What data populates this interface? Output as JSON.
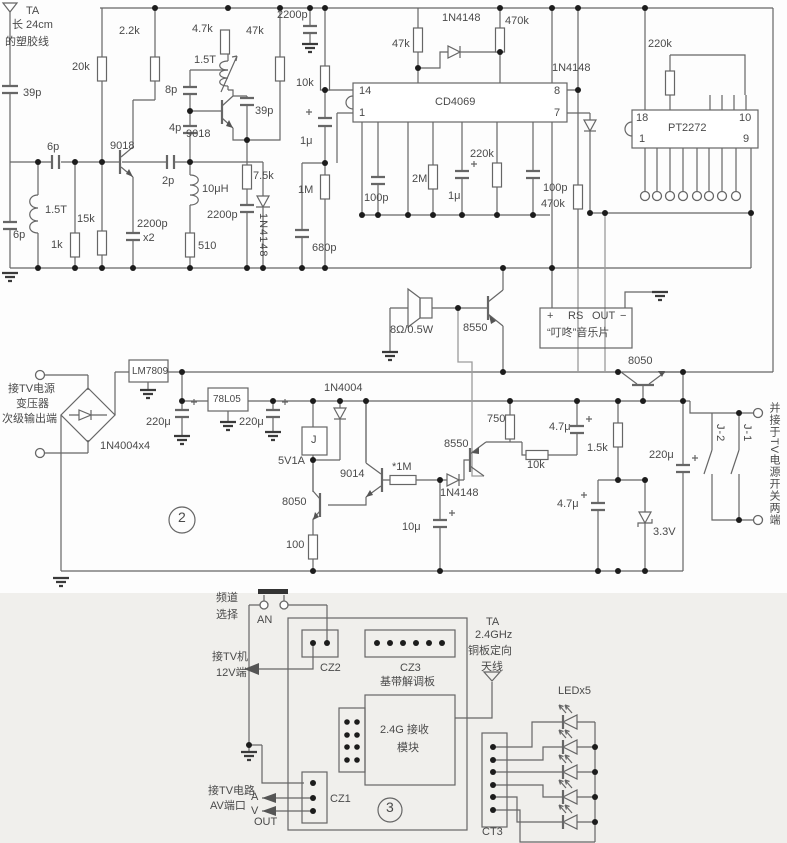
{
  "colors": {
    "wire": "#666666",
    "light_wire": "#9b9b9b",
    "text": "#4a4a4a",
    "panel_bg": "#f0efec",
    "background": "#fdfdfd"
  },
  "s1": {
    "ant_ta": "TA",
    "ant_note1": "长 24cm",
    "ant_note2": "的塑胶线",
    "c39p": "39p",
    "c6p_a": "6p",
    "l1_5t_a": "1.5T",
    "c6p_b": "6p",
    "r1k": "1k",
    "r15k": "15k",
    "r20k": "20k",
    "q1": "9018",
    "c2p": "2p",
    "r2_2k": "2.2k",
    "r4_7k": "4.7k",
    "r47k_a": "47k",
    "c8p": "8p",
    "l1_5t_b": "1.5T",
    "c4p": "4p",
    "q2": "9018",
    "c39p_b": "39p",
    "r7_5k": "7.5k",
    "l10uh": "10μH",
    "c2200p_b": "2200p",
    "c2200p_x2": "x2",
    "c2200p_c": "2200p",
    "r510": "510",
    "d1": "1N4148",
    "c2200p_d": "2200p",
    "r10k": "10k",
    "c1u_a": "1μ",
    "r1m": "1M",
    "c680p": "680p",
    "r47k_b": "47k",
    "d2": "1N4148",
    "r470k_a": "470k",
    "ic1": "CD4069",
    "pin14": "14",
    "pin1": "1",
    "pin8": "8",
    "pin7": "7",
    "c100p_a": "100p",
    "r2m": "2M",
    "c1u_b": "1μ",
    "r220k_a": "220k",
    "c100p_b": "100p",
    "d3": "1N4148",
    "r470k_b": "470k",
    "r220k_b": "220k",
    "ic2": "PT2272",
    "pin18": "18",
    "pin1b": "1",
    "pin10": "10",
    "pin9": "9"
  },
  "s2": {
    "spk": "8Ω/0.5W",
    "q3": "8550",
    "music_plus": "+",
    "music_rs": "RS",
    "music_out": "OUT",
    "music_minus": "−",
    "music_name": "“叮咚”音乐片",
    "q4": "8050",
    "in_note1": "接TV电源",
    "in_note2": "变压器",
    "in_note3": "次级输出端",
    "bridge": "1N4004x4",
    "reg1": "LM7809",
    "c220u_a": "220μ",
    "reg2": "78L05",
    "c220u_b": "220μ",
    "sec_no": "2",
    "d4": "1N4004",
    "relay": "J",
    "zener1": "5V1A",
    "q5": "8050",
    "r100": "100",
    "q6": "9014",
    "r1m_star": "*1M",
    "q7": "8550",
    "d5": "1N4148",
    "r750": "750",
    "c10u": "10μ",
    "r10k_b": "10k",
    "c4_7u_a": "4.7μ",
    "r1_5k": "1.5k",
    "c220u_c": "220μ",
    "c4_7u_b": "4.7μ",
    "zener2": "3.3V",
    "j1": "J-1",
    "j2": "J-2",
    "out_note": "并接于TV电源开关两端"
  },
  "s3": {
    "ch_note1": "频道",
    "ch_note2": "选择",
    "an": "AN",
    "tv12_1": "接TV机",
    "tv12_2": "12V端",
    "cz2": "CZ2",
    "cz3": "CZ3",
    "board": "基带解调板",
    "module1": "2.4G 接收",
    "module2": "模块",
    "cz1": "CZ1",
    "av1": "接TV电路",
    "av_a": "A",
    "av2": "AV端口",
    "av_v": "V",
    "av_out": "OUT",
    "sec_no": "3",
    "ant_ta": "TA",
    "ant_f": "2.4GHz",
    "ant_n1": "铜板定向",
    "ant_n2": "天线",
    "led": "LEDx5",
    "ct3": "CT3"
  }
}
